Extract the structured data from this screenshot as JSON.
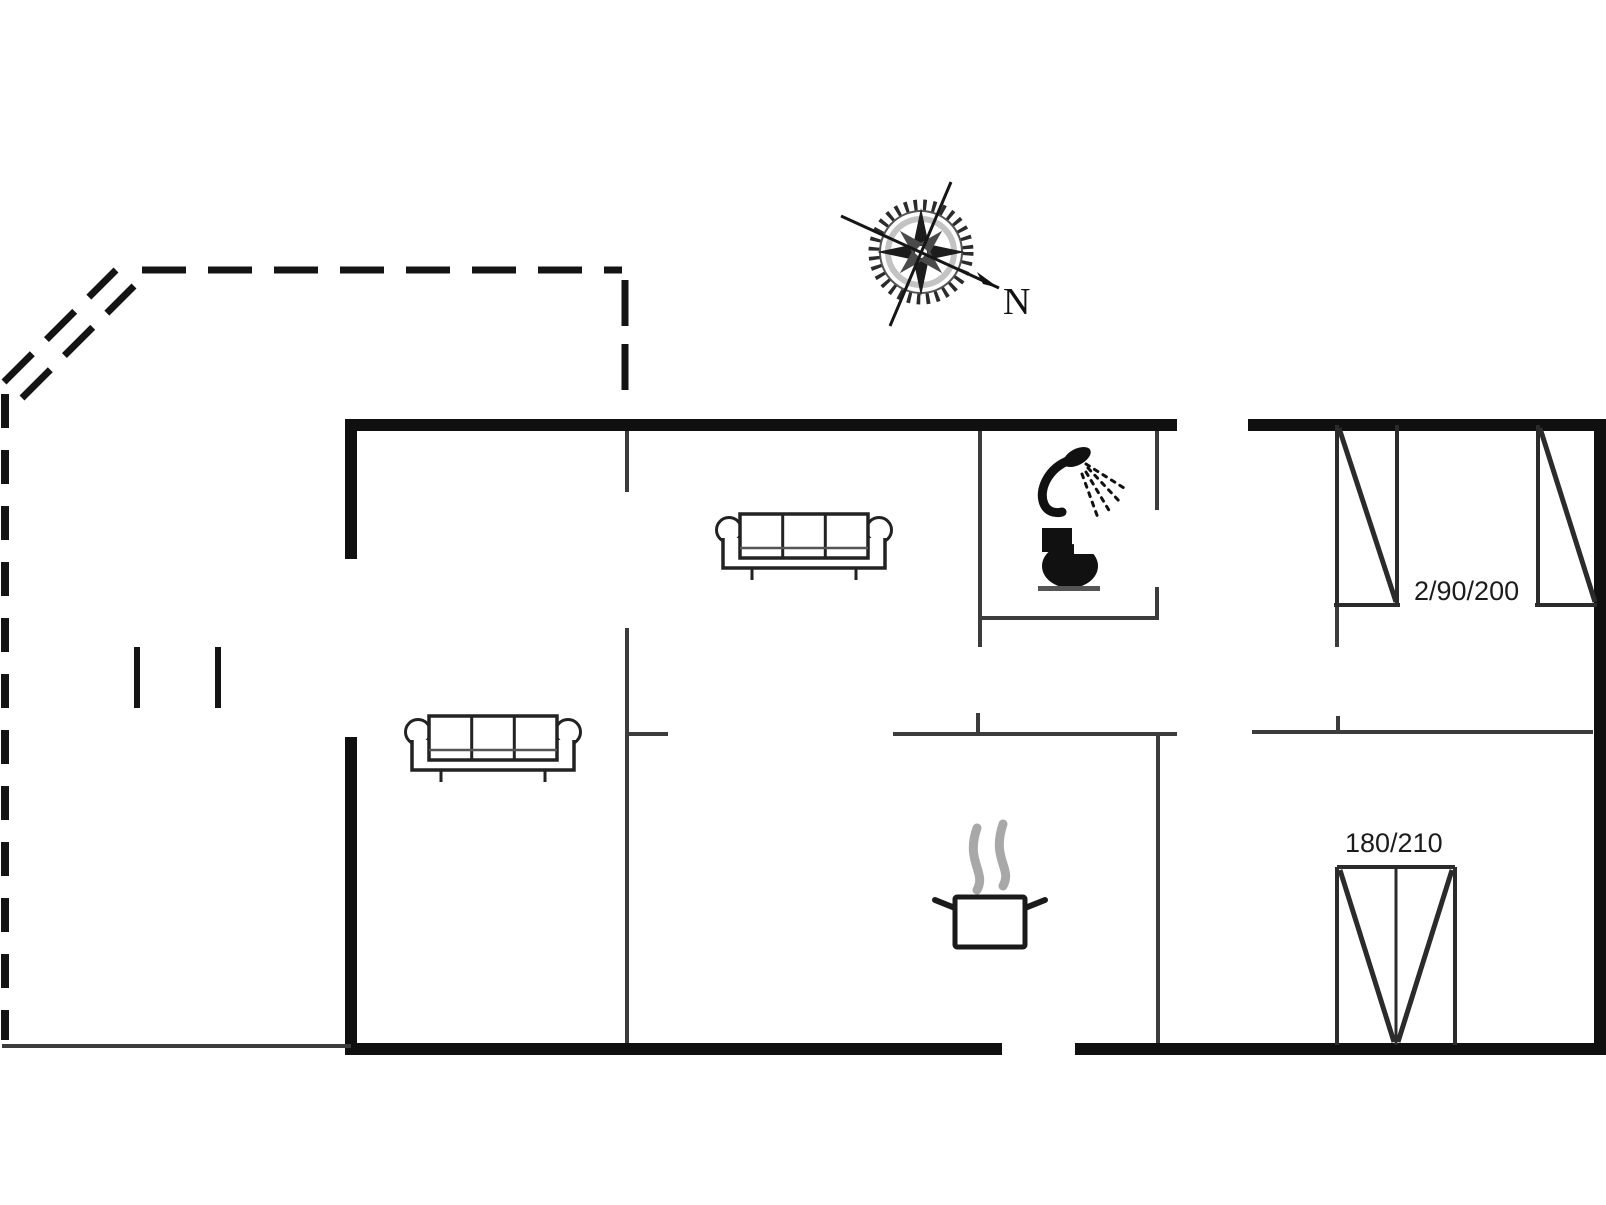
{
  "page": {
    "background": "#ffffff",
    "ink": "#111111",
    "thin_wall_color": "#3c3c3c",
    "steam_color": "#a8a8a8"
  },
  "plan": {
    "labels": {
      "single_beds_size": "2/90/200",
      "double_bed_size": "180/210",
      "compass_north": "N"
    },
    "icons": [
      {
        "name": "compass-rose-icon",
        "meaning": "north direction indicator"
      },
      {
        "name": "sofa-icon",
        "count": 2
      },
      {
        "name": "shower-icon",
        "meaning": "bathroom shower"
      },
      {
        "name": "toilet-icon",
        "meaning": "bathroom toilet"
      },
      {
        "name": "cooking-pot-icon",
        "meaning": "kitchen / stove"
      },
      {
        "name": "single-bed-icon",
        "count": 2
      },
      {
        "name": "double-bed-icon",
        "count": 1
      },
      {
        "name": "terrace-dashed-outline",
        "meaning": "terrace boundary"
      }
    ]
  }
}
